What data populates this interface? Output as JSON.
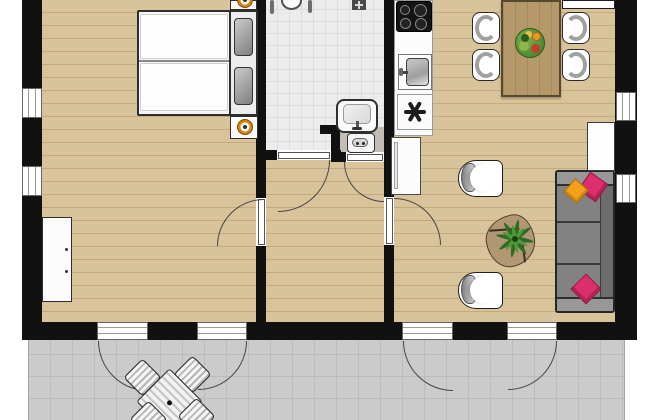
{
  "meta": {
    "type": "floor-plan",
    "view": "top-down-2d",
    "canvas": {
      "width_px": 650,
      "height_px": 420
    },
    "note": "Apartment floor plan, cropped at top and bottom edges; no text labels rendered in the drawing"
  },
  "colors": {
    "wall": "#111111",
    "wood": "#d9c39b",
    "wood_line": "#c4aa7d",
    "tile": "#ececec",
    "tile_line": "#dddddd",
    "niche": "#c2beb5",
    "terrace": "#cbcbcb",
    "terrace_line": "#bbbbbb",
    "table_wood": "#b5996b",
    "coffee_wood": "#b29872",
    "sofa_body": "#828282",
    "sofa_back": "#6d6d6d",
    "sofa_arm": "#989898",
    "pillow_orange": "#f3a11b",
    "pillow_pink": "#dd2f6d",
    "plant_dark": "#2f6b27",
    "plant_light": "#4f9a38",
    "lamp_orange": "#e08c14",
    "outline": "#2e2e2e",
    "arc": "#454545",
    "fixture": "#fafafa"
  },
  "rooms": [
    {
      "name": "bedroom",
      "floor": "wood plank",
      "items": [
        "double bed with two white duvets",
        "two grey pillows",
        "nightstand with orange lamp (top, cut off)",
        "nightstand with orange lamp (bottom)",
        "white wardrobe on left wall"
      ]
    },
    {
      "name": "bathroom",
      "floor": "white tile",
      "items": [
        "toilet partially visible at top edge",
        "dark wall vent with star mark",
        "washbasin with tap"
      ]
    },
    {
      "name": "laundry-niche",
      "floor": "grey screed",
      "items": [
        "washing machine"
      ]
    },
    {
      "name": "hallway",
      "floor": "wood plank",
      "items": []
    },
    {
      "name": "kitchen",
      "floor": "wood plank",
      "items": [
        "four-burner gas hob",
        "stainless kitchen sink with tap",
        "appliance marked with asterisk",
        "tall fridge cabinet with handle"
      ]
    },
    {
      "name": "living-dining-room",
      "floor": "wood plank",
      "items": [
        "wooden dining table",
        "fruit bowl",
        "four dining chairs",
        "white sideboard strip at top wall",
        "two white armchairs",
        "organic-shaped coffee table",
        "green plant",
        "three-seat grey sofa",
        "one orange cushion",
        "two pink cushions",
        "white side table"
      ]
    },
    {
      "name": "terrace",
      "floor": "concrete tile",
      "items": [
        "square garden table rotated 45 degrees with centre dot",
        "four slatted garden chairs (lower two cut off)"
      ]
    }
  ],
  "openings": {
    "left_wall_windows": 2,
    "right_wall_windows": 2,
    "terrace_door_openings_in_bottom_wall": 4,
    "interior_door_swings": [
      "bedroom",
      "living-room",
      "bathroom",
      "laundry-niche"
    ],
    "terrace_door_swings": 4
  }
}
